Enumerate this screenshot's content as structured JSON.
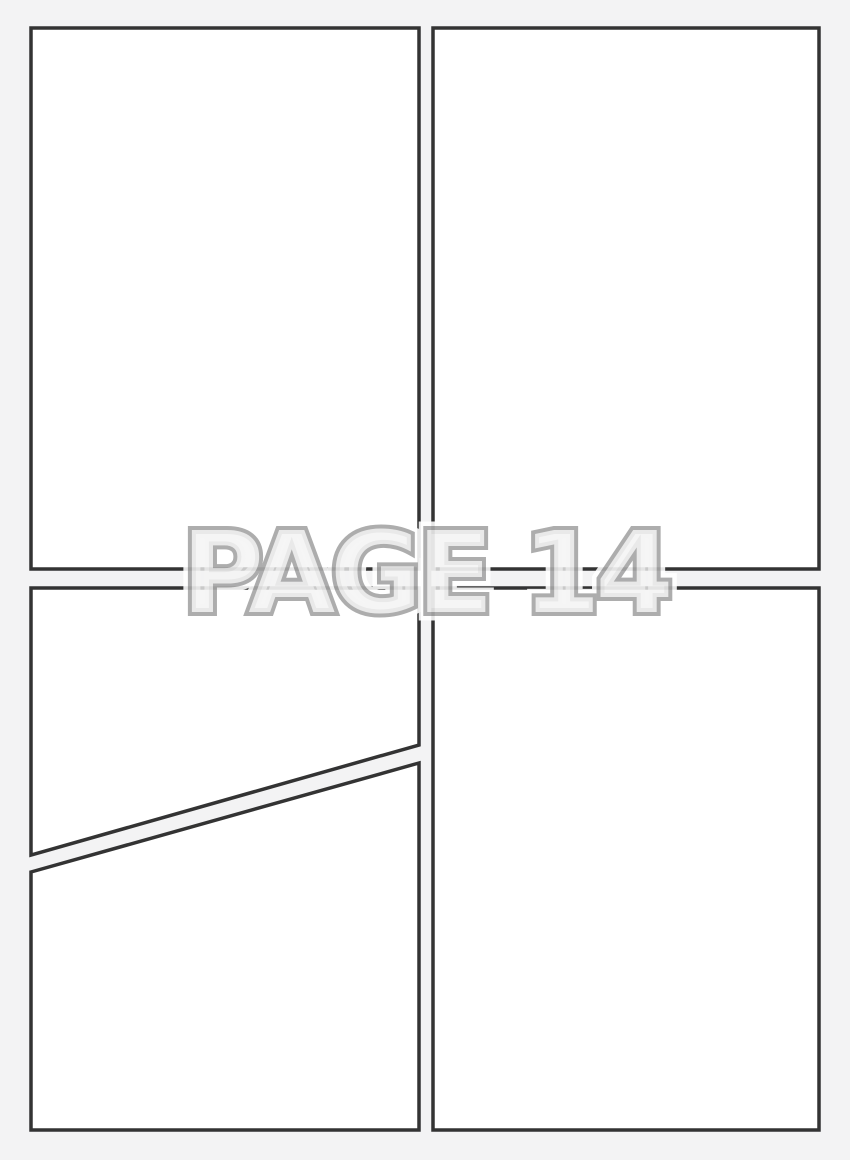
{
  "page": {
    "title_label": "PAGE 14"
  },
  "colors": {
    "background": "#f3f3f4",
    "panel_fill": "#ffffff",
    "panel_border": "#333333",
    "label_fill": "#f1f1f1",
    "label_stroke": "#a7a7a7",
    "label_halo": "#ffffff"
  },
  "panels": [
    {
      "name": "top-left"
    },
    {
      "name": "top-right"
    },
    {
      "name": "middle-left-diagonal-top"
    },
    {
      "name": "bottom-left-diagonal-bottom"
    },
    {
      "name": "bottom-right"
    }
  ]
}
